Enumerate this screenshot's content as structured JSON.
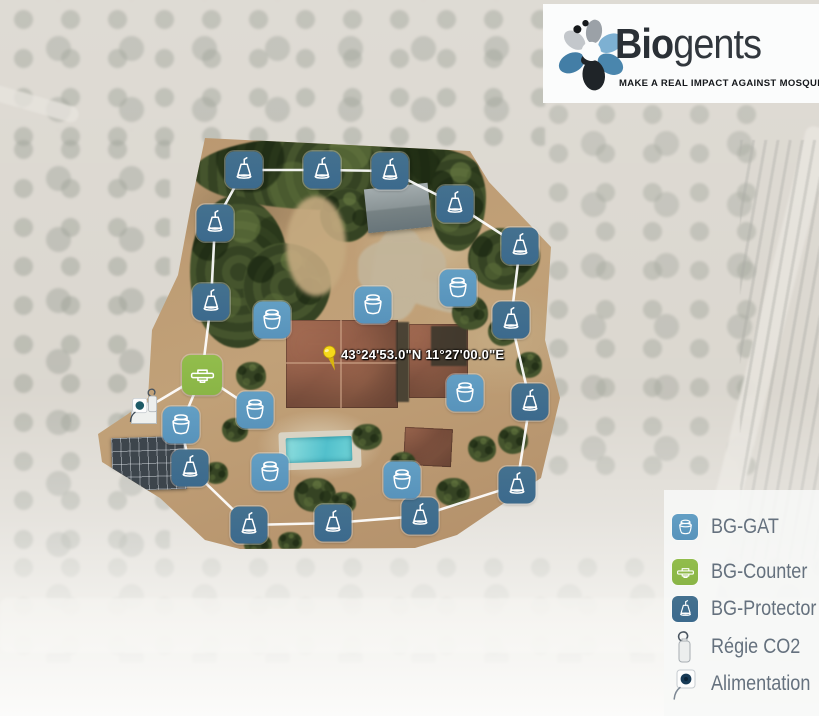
{
  "logo": {
    "brand_bold": "Bio",
    "brand_light": "gents",
    "tagline": "MAKE A REAL IMPACT AGAINST MOSQUITOES"
  },
  "map": {
    "pin_label": "43°24'53.0\"N 11°27'00.0\"E",
    "colors": {
      "gat": "#639fc4",
      "counter": "#92bd4c",
      "protector": "#3c6a8d",
      "route": "#ffffff"
    },
    "markers": [
      {
        "type": "protector",
        "x": 244,
        "y": 170
      },
      {
        "type": "protector",
        "x": 322,
        "y": 170
      },
      {
        "type": "protector",
        "x": 390,
        "y": 171
      },
      {
        "type": "protector",
        "x": 455,
        "y": 204
      },
      {
        "type": "protector",
        "x": 520,
        "y": 246
      },
      {
        "type": "protector",
        "x": 511,
        "y": 320
      },
      {
        "type": "protector",
        "x": 530,
        "y": 402
      },
      {
        "type": "protector",
        "x": 517,
        "y": 485
      },
      {
        "type": "protector",
        "x": 420,
        "y": 516
      },
      {
        "type": "protector",
        "x": 333,
        "y": 523
      },
      {
        "type": "protector",
        "x": 249,
        "y": 525
      },
      {
        "type": "protector",
        "x": 190,
        "y": 468
      },
      {
        "type": "protector",
        "x": 215,
        "y": 223
      },
      {
        "type": "protector",
        "x": 211,
        "y": 302
      },
      {
        "type": "gat",
        "x": 272,
        "y": 320
      },
      {
        "type": "gat",
        "x": 373,
        "y": 305
      },
      {
        "type": "gat",
        "x": 458,
        "y": 288
      },
      {
        "type": "gat",
        "x": 465,
        "y": 393
      },
      {
        "type": "gat",
        "x": 255,
        "y": 410
      },
      {
        "type": "gat",
        "x": 181,
        "y": 425
      },
      {
        "type": "gat",
        "x": 270,
        "y": 472
      },
      {
        "type": "gat",
        "x": 402,
        "y": 480
      },
      {
        "type": "counter",
        "x": 202,
        "y": 375
      }
    ],
    "equipment": [
      {
        "type": "co2",
        "x": 153,
        "y": 403
      },
      {
        "type": "outlet",
        "x": 139,
        "y": 412
      }
    ],
    "routes": {
      "perimeter": [
        [
          244,
          170
        ],
        [
          322,
          170
        ],
        [
          390,
          171
        ],
        [
          455,
          204
        ],
        [
          520,
          246
        ],
        [
          511,
          320
        ],
        [
          530,
          402
        ],
        [
          517,
          485
        ],
        [
          420,
          516
        ],
        [
          333,
          523
        ],
        [
          249,
          525
        ],
        [
          190,
          468
        ],
        [
          181,
          425
        ],
        [
          202,
          375
        ],
        [
          211,
          302
        ],
        [
          215,
          223
        ],
        [
          244,
          170
        ]
      ],
      "spurs": [
        [
          [
            202,
            375
          ],
          [
            160,
            400
          ],
          [
            139,
            412
          ]
        ],
        [
          [
            202,
            375
          ],
          [
            255,
            410
          ]
        ]
      ]
    }
  },
  "legend": {
    "items": [
      {
        "id": "gat",
        "label": "BG-GAT",
        "color": "#639fc4"
      },
      {
        "id": "counter",
        "label": "BG-Counter",
        "color": "#92bd4c"
      },
      {
        "id": "protector",
        "label": "BG-Protector",
        "color": "#3c6a8d"
      },
      {
        "id": "co2",
        "label": "Régie CO2"
      },
      {
        "id": "alimentation",
        "label": "Alimentation"
      }
    ]
  }
}
